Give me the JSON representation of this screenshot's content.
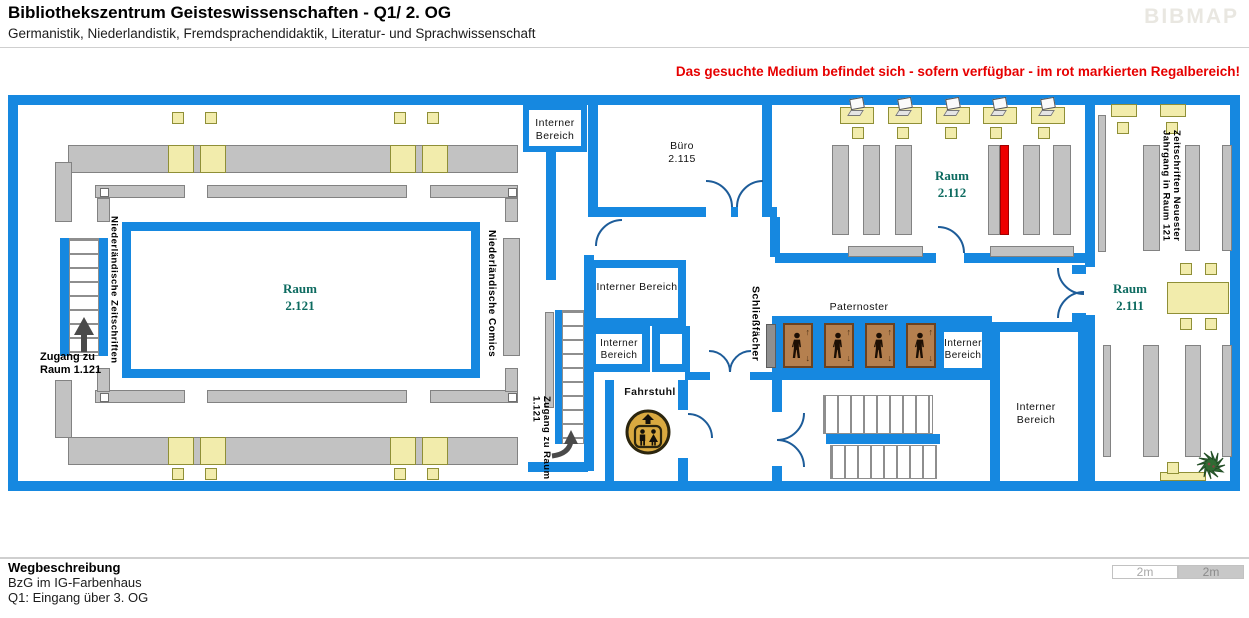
{
  "header": {
    "title": "Bibliothekszentrum Geisteswissenschaften - Q1/ 2. OG",
    "subtitle": "Germanistik, Niederlandistik, Fremdsprachendidaktik, Literatur- und Sprachwissenschaft",
    "logo": "BIBMAP"
  },
  "notice": "Das gesuchte Medium befindet sich - sofern verfügbar -  im rot markierten Regalbereich!",
  "rooms": {
    "r2121": {
      "name": "Raum",
      "number": "2.121"
    },
    "r2112": {
      "name": "Raum",
      "number": "2.112"
    },
    "r2111": {
      "name": "Raum",
      "number": "2.111"
    },
    "buero": {
      "name": "Büro",
      "number": "2.115"
    }
  },
  "labels": {
    "interner": "Interner Bereich",
    "paternoster": "Paternoster",
    "fahrstuhl": "Fahrstuhl",
    "schliessfaecher": "Schließfächer",
    "ndl_zeitschriften": "Niederländische Zeitschriften",
    "ndl_comics": "Niederländische Comics",
    "zs_line1": "Zeitschriften Neuester",
    "zs_line2": "Jahrgang in Raum 121",
    "zugang": "Zugang zu Raum 1.121"
  },
  "footer": {
    "heading": "Wegbeschreibung",
    "line1": "BzG im IG-Farbenhaus",
    "line2": "Q1: Eingang über 3. OG"
  },
  "scale": {
    "left": "2m",
    "right": "2m"
  },
  "colors": {
    "wall": "#1688e0",
    "highlight": "#ee0000",
    "shelf": "#c2c2c2",
    "table": "#f2ecac",
    "room_label": "#0d6b60",
    "notice": "#e60000"
  }
}
